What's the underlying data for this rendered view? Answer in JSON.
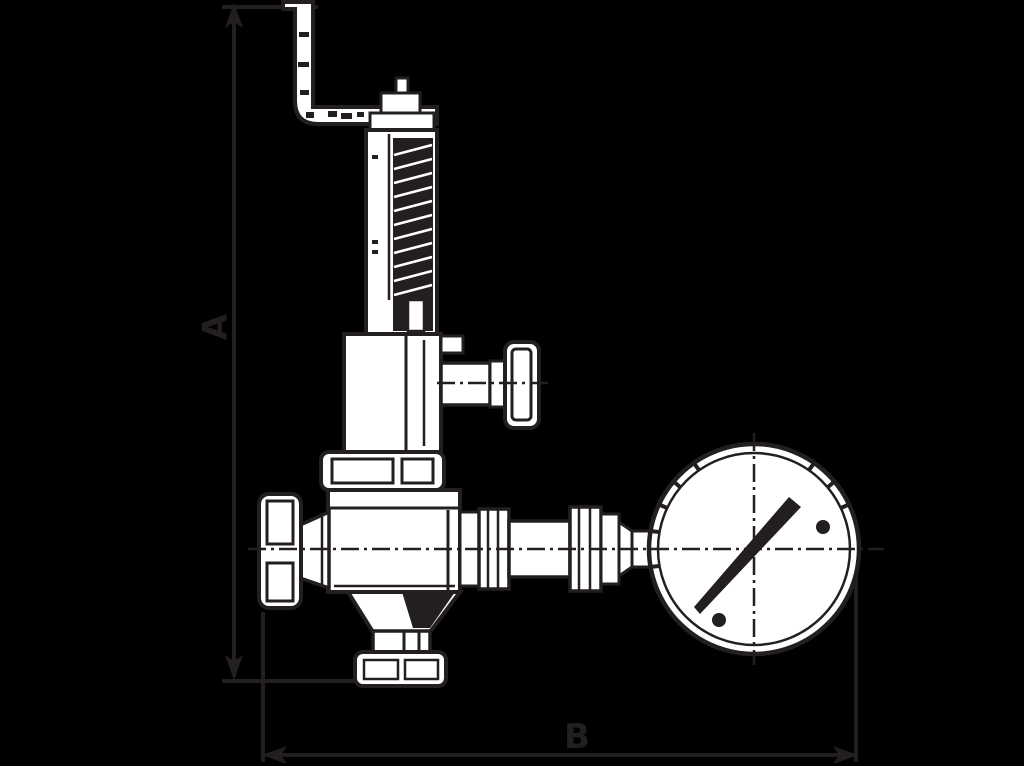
{
  "page": {
    "background_color": "#000000",
    "line_color": "#231f20",
    "fill_color": "#ffffff"
  },
  "drawing": {
    "kind": "technical-dimension-drawing",
    "subject": "safety-relief-valve-with-pressure-gauge",
    "dimensions": {
      "vertical": {
        "label": "A",
        "orientation": "vertical"
      },
      "horizontal": {
        "label": "B",
        "orientation": "horizontal"
      }
    },
    "components": [
      "lift-lever",
      "bonnet-cap",
      "spring-bonnet",
      "upper-valve-body",
      "side-outlet-knob",
      "body-flange",
      "lower-valve-body",
      "shutoff-handwheel",
      "bottom-flange",
      "gauge-piping",
      "pressure-gauge",
      "gauge-needle"
    ]
  }
}
